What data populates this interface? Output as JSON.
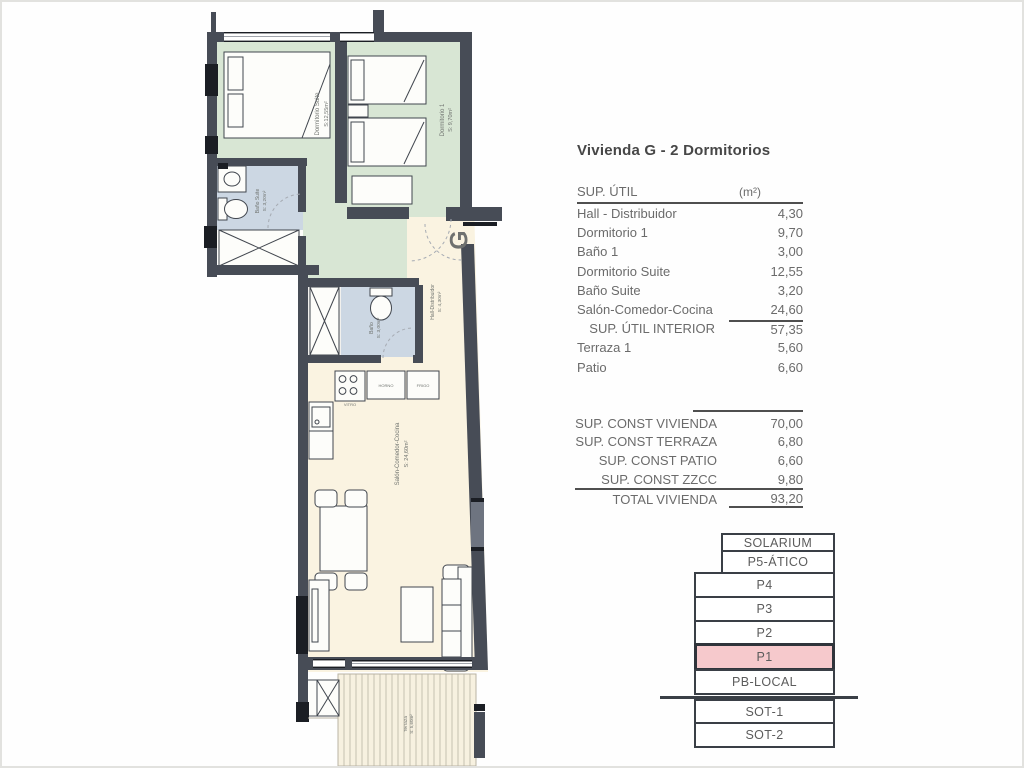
{
  "title": "Vivienda G - 2 Dormitorios",
  "sup_util_table": {
    "header_label": "SUP. ÚTIL",
    "header_unit": "(m²)",
    "rows": [
      {
        "label": "Hall - Distribuidor",
        "value": "4,30"
      },
      {
        "label": "Dormitorio 1",
        "value": "9,70"
      },
      {
        "label": "Baño 1",
        "value": "3,00"
      },
      {
        "label": "Dormitorio Suite",
        "value": "12,55"
      },
      {
        "label": "Baño Suite",
        "value": "3,20"
      },
      {
        "label": "Salón-Comedor-Cocina",
        "value": "24,60"
      },
      {
        "label": "SUP. ÚTIL INTERIOR",
        "value": "57,35"
      },
      {
        "label": "Terraza 1",
        "value": "5,60"
      },
      {
        "label": "Patio",
        "value": "6,60"
      }
    ]
  },
  "sup_const_table": {
    "rows": [
      {
        "label": "SUP. CONST VIVIENDA",
        "value": "70,00"
      },
      {
        "label": "SUP. CONST TERRAZA",
        "value": "6,80"
      },
      {
        "label": "SUP. CONST PATIO",
        "value": "6,60"
      },
      {
        "label": "SUP. CONST ZZCC",
        "value": "9,80"
      },
      {
        "label": "TOTAL VIVIENDA",
        "value": "93,20"
      }
    ]
  },
  "floor_stack": {
    "highlighted_floor": "P1",
    "highlight_color": "#f6c9cc",
    "floors": [
      {
        "label": "SOLARIUM"
      },
      {
        "label": "P5-ÁTICO"
      },
      {
        "label": "P4"
      },
      {
        "label": "P3"
      },
      {
        "label": "P2"
      },
      {
        "label": "P1"
      },
      {
        "label": "PB-LOCAL"
      },
      {
        "label": "SOT-1"
      },
      {
        "label": "SOT-2"
      }
    ]
  },
  "plan": {
    "unit_letter": "G",
    "rooms": [
      {
        "label": "Dormitorio Suite",
        "area": "S:12,55m²"
      },
      {
        "label": "Dormitorio 1",
        "area": "S: 9,70m²"
      },
      {
        "label": "Baño Suite",
        "area": "S: 3,20m²"
      },
      {
        "label": "Baño",
        "area": "S: 3,00m²"
      },
      {
        "label": "Hall-Distribuidor",
        "area": "S: 4,30m²"
      },
      {
        "label": "Salón-Comedor-Cocina",
        "area": "S: 24,60m²"
      },
      {
        "label": "Terraza",
        "area": "S: 5,60m²"
      }
    ],
    "appliance_labels": [
      "HORNO",
      "FRIGO",
      "VITRO"
    ],
    "colors": {
      "wall": "#474c56",
      "bedroom": "#d8e6d4",
      "bathroom": "#ccd7e3",
      "living": "#faf3e1"
    }
  }
}
